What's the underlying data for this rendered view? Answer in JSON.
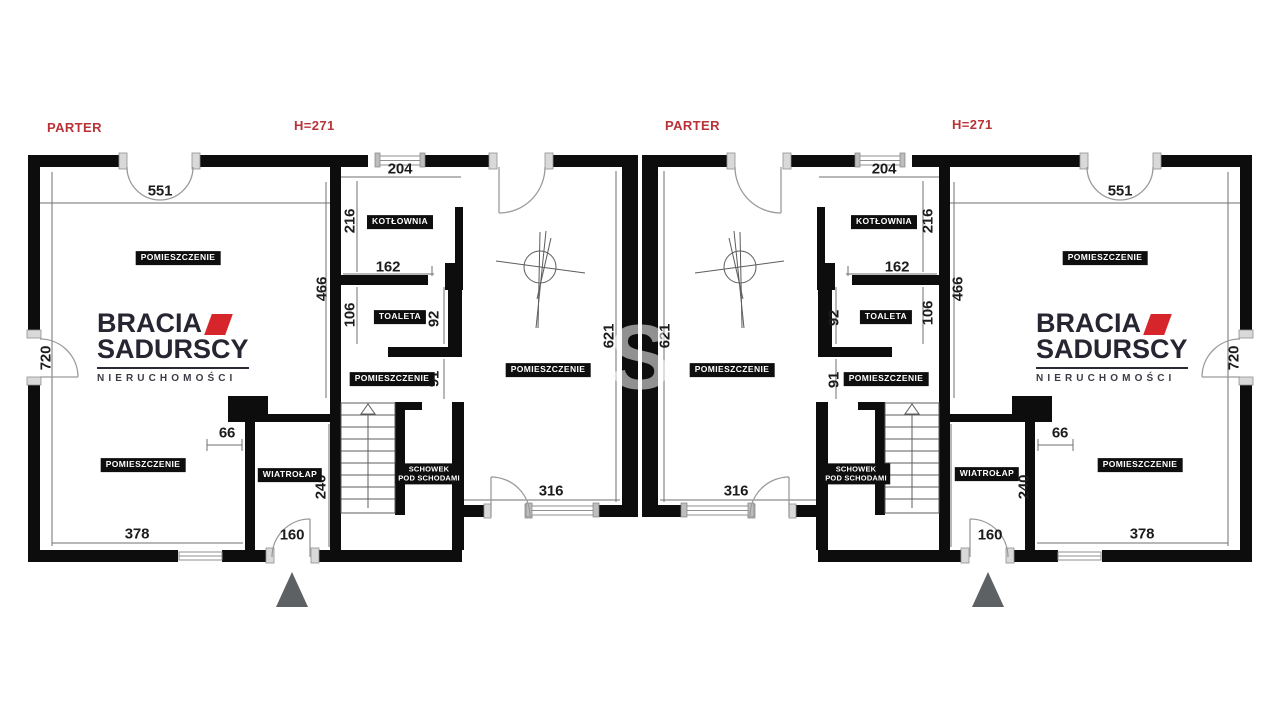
{
  "header": {
    "floor_label": "PARTER",
    "height_label": "H=271"
  },
  "rooms": {
    "room": "POMIESZCZENIE",
    "boiler": "KOTŁOWNIA",
    "toilet": "TOALETA",
    "vestibule": "WIATROŁAP",
    "storage_l1": "SCHOWEK",
    "storage_l2": "POD SCHODAMI"
  },
  "dims": {
    "top_door": "551",
    "boiler_window": "204",
    "boiler_height": "216",
    "boiler_width": "162",
    "column_height": "466",
    "toilet_height": "106",
    "toilet_width": "92",
    "hall_width": "91",
    "living_height": "621",
    "side_height": "720",
    "wall_offset": "66",
    "vestibule_height": "240",
    "entry_door": "160",
    "room_width": "378",
    "terrace_door": "316"
  },
  "logo": {
    "line1": "BRACIA",
    "line2": "SADURSCY",
    "line3": "NIERUCHOMOŚCI"
  },
  "watermark": {
    "letter": "S"
  },
  "colors": {
    "wall": "#0d0d0d",
    "red_label": "#b93238",
    "logo_red": "#d7252c",
    "logo_dark": "#262531",
    "entrance_arrow": "#5e6163"
  }
}
